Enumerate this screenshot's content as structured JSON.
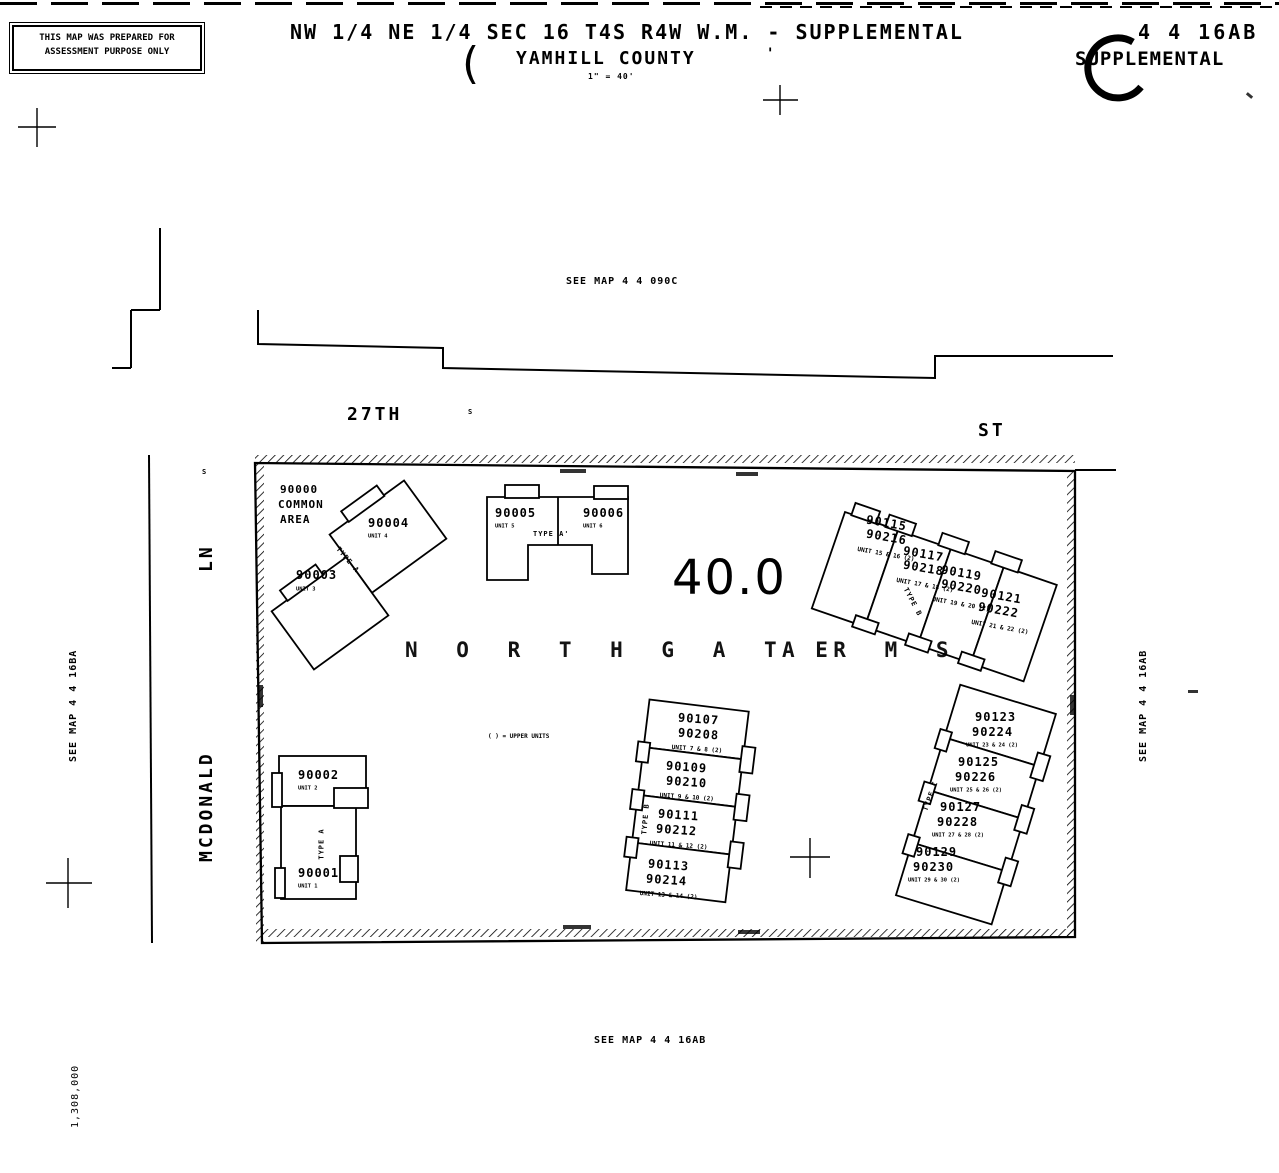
{
  "header": {
    "disclaimer_line1": "THIS MAP WAS PREPARED FOR",
    "disclaimer_line2": "ASSESSMENT PURPOSE ONLY",
    "title": "NW 1/4 NE 1/4 SEC 16 T4S R4W W.M. - SUPPLEMENTAL",
    "county": "YAMHILL COUNTY",
    "scale": "1\" = 40'",
    "map_number": "4 4 16AB",
    "map_label": "SUPPLEMENTAL"
  },
  "references": {
    "north": "SEE MAP 4 4 090C",
    "west": "SEE MAP 4 4 16BA",
    "east": "SEE MAP 4 4 16AB",
    "south": "SEE MAP 4 4 16AB"
  },
  "streets": {
    "north_name": "27TH",
    "north_type": "ST",
    "north_marker": "S",
    "west_name": "MCDONALD",
    "west_type": "LN",
    "west_marker": "S"
  },
  "parcel": {
    "acreage": "40.0",
    "name_part1": "N O R T H G A T E",
    "name_part2": "A R M S",
    "common_area_line1": "90000",
    "common_area_line2": "COMMON",
    "common_area_line3": "AREA",
    "note": "( ) = UPPER UNITS",
    "coordinate_label": "1,308,000"
  },
  "misc": {
    "paren": "(",
    "tick": "'"
  },
  "buildings": {
    "b1": {
      "type_label": "TYPE A",
      "units": [
        {
          "num": "90003",
          "sub": "UNIT 3"
        },
        {
          "num": "90004",
          "sub": "UNIT 4"
        }
      ]
    },
    "b2": {
      "type_label": "TYPE A'",
      "units": [
        {
          "num": "90005",
          "sub": "UNIT 5"
        },
        {
          "num": "90006",
          "sub": "UNIT 6"
        }
      ]
    },
    "b3": {
      "type_label": "TYPE B",
      "units": [
        {
          "lower": "90115",
          "upper": "90216",
          "sub": "UNIT 15 & 16 (2)"
        },
        {
          "lower": "90117",
          "upper": "90218",
          "sub": "UNIT 17 & 18 (2)"
        },
        {
          "lower": "90119",
          "upper": "90220",
          "sub": "UNIT 19 & 20 (2)"
        },
        {
          "lower": "90121",
          "upper": "90222",
          "sub": "UNIT 21 & 22 (2)"
        }
      ]
    },
    "b4": {
      "type_label": "TYPE B",
      "units": [
        {
          "lower": "90107",
          "upper": "90208",
          "sub": "UNIT 7 & 8 (2)"
        },
        {
          "lower": "90109",
          "upper": "90210",
          "sub": "UNIT 9 & 10 (2)"
        },
        {
          "lower": "90111",
          "upper": "90212",
          "sub": "UNIT 11 & 12 (2)"
        },
        {
          "lower": "90113",
          "upper": "90214",
          "sub": "UNIT 13 & 14 (2)"
        }
      ]
    },
    "b5": {
      "type_label": "TYPE C",
      "units": [
        {
          "lower": "90123",
          "upper": "90224",
          "sub": "UNIT 23 & 24 (2)"
        },
        {
          "lower": "90125",
          "upper": "90226",
          "sub": "UNIT 25 & 26 (2)"
        },
        {
          "lower": "90127",
          "upper": "90228",
          "sub": "UNIT 27 & 28 (2)"
        },
        {
          "lower": "90129",
          "upper": "90230",
          "sub": "UNIT 29 & 30 (2)"
        }
      ]
    },
    "b6": {
      "type_label": "TYPE A",
      "units": [
        {
          "num": "90001",
          "sub": "UNIT 1"
        },
        {
          "num": "90002",
          "sub": "UNIT 2"
        }
      ]
    }
  }
}
